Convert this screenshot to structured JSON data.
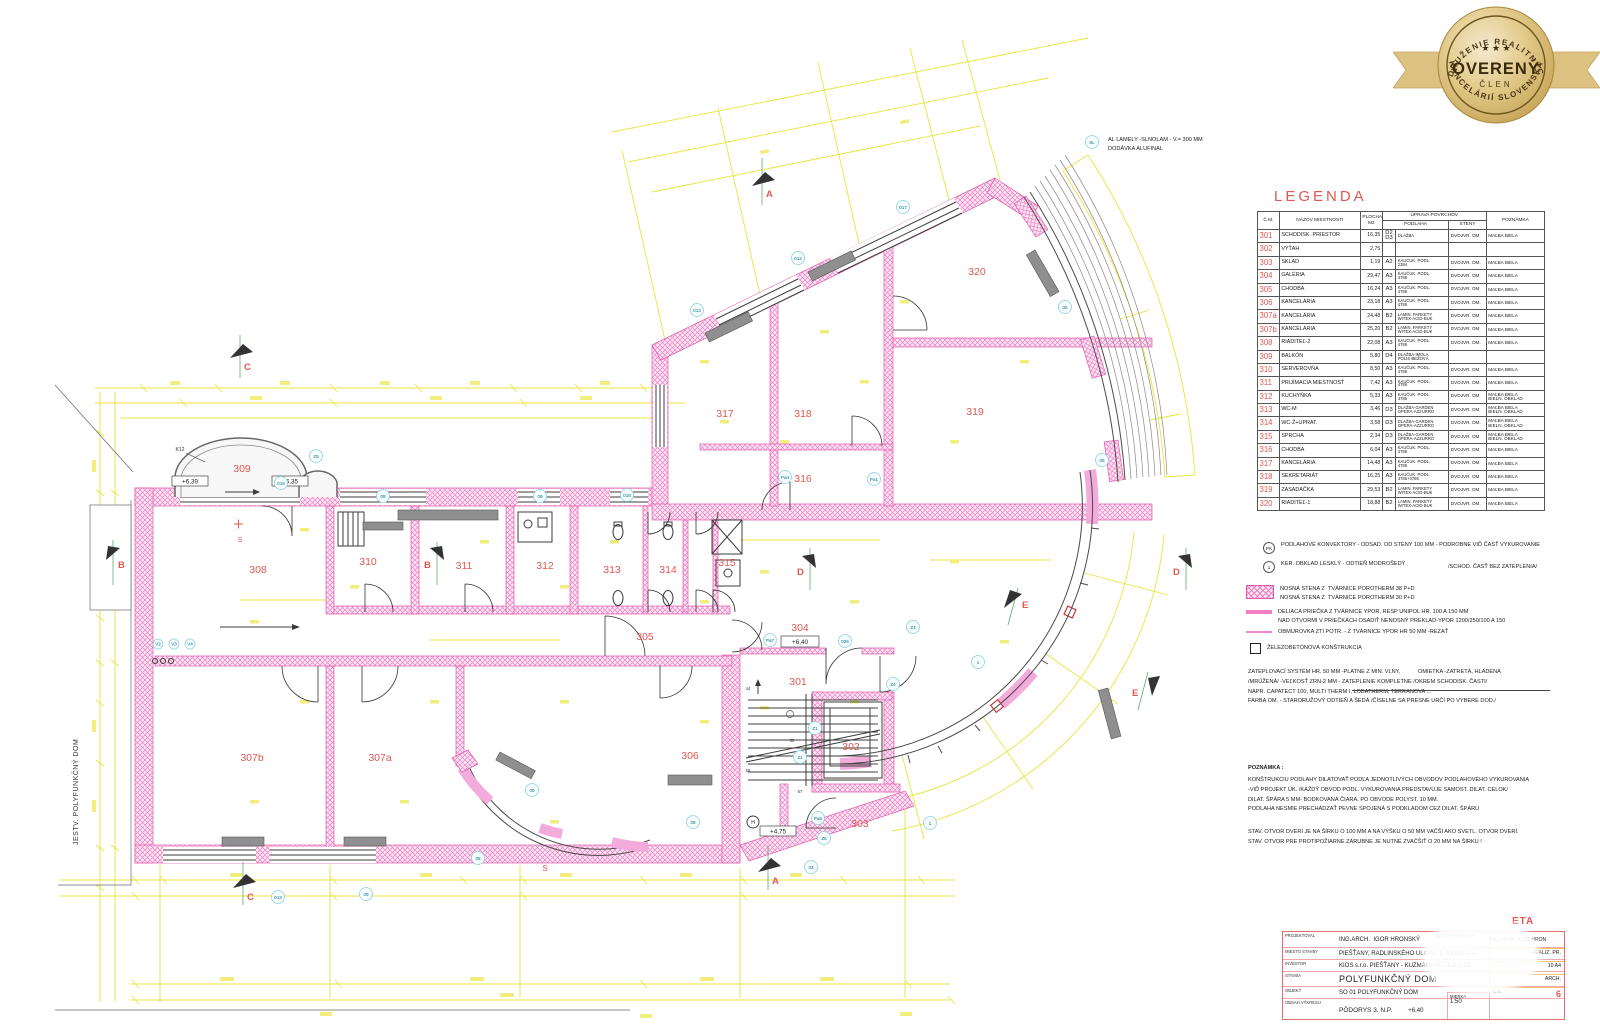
{
  "badge": {
    "arc_top": "ZDRUŽENIE REALITNÝCH",
    "arc_bottom": "KANCELÁRIÍ SLOVENSKA",
    "center": "OVERENÝ",
    "sub": "ČLEN"
  },
  "plan": {
    "existing_label": "JESTV. POLYFUNKČNÝ DOM",
    "sl_code": "SL",
    "sl_line1": "AL LAMELY -SLNOLAM - V.= 300 MM",
    "sl_line2": "DODÁVKA ALUFINAL",
    "k12": "K12",
    "s_label": "S",
    "rooms": [
      "301",
      "302",
      "303",
      "304",
      "305",
      "306",
      "307a",
      "307b",
      "308",
      "309",
      "310",
      "311",
      "312",
      "313",
      "314",
      "315",
      "316",
      "317",
      "318",
      "319",
      "320"
    ],
    "levels": [
      "+6,39",
      "+6,35",
      "+6,40",
      "+4,75"
    ],
    "sections": [
      "A",
      "B",
      "C",
      "D",
      "E"
    ],
    "marks": [
      "019",
      "09",
      "09",
      "018",
      "013",
      "012",
      "017",
      "05",
      "05",
      "Z5",
      "026",
      "Z4",
      "1",
      "1",
      "Pa4",
      "Pa1",
      "Pa7",
      "Pa5",
      "21",
      "Z6",
      "Z4",
      "03",
      "08",
      "013",
      "09",
      "08",
      "09",
      "Z1",
      "V2",
      "V3",
      "V4",
      "H"
    ],
    "stair_marks": [
      "44",
      "50",
      "58",
      "57"
    ]
  },
  "legend": {
    "title": "LEGENDA",
    "headers": {
      "cm": "Č.M.",
      "name": "NÁZOV MIESTNOSTI",
      "area": "PLOCHA\nM2",
      "surfaces": "ÚPRAVA POVRCHOV",
      "floor": "PODLAHA",
      "walls": "STENY",
      "note": "POZNÁMKA"
    },
    "rows": [
      {
        "cm": "301",
        "name": "SCHODISK. PRIESTOR",
        "area": "16,35",
        "code": "D2\nD3",
        "floor": "DLAŽBA",
        "walls": "DVOJVR. OM.",
        "note": "MAĽBA BIELA"
      },
      {
        "cm": "302",
        "name": "VÝŤAH",
        "area": "2,75",
        "code": "",
        "floor": "",
        "walls": "",
        "note": ""
      },
      {
        "cm": "303",
        "name": "SKLAD",
        "area": "1,19",
        "code": "A2",
        "floor": "KAUČUK. PODL.\n2394",
        "walls": "DVOJVR. OM.",
        "note": "MAĽBA BIELA"
      },
      {
        "cm": "304",
        "name": "GALÉRIA",
        "area": "29,47",
        "code": "A3",
        "floor": "KAUČUK. PODL.\n4786",
        "walls": "DVOJVR. OM.",
        "note": "MAĽBA BIELA"
      },
      {
        "cm": "305",
        "name": "CHODBA",
        "area": "16,24",
        "code": "A3",
        "floor": "KAUČUK. PODL.\n4786",
        "walls": "DVOJVR. OM.",
        "note": "MAĽBA BIELA"
      },
      {
        "cm": "306",
        "name": "KANCELÁRIA",
        "area": "23,18",
        "code": "A3",
        "floor": "KAUČUK. PODL.\n4786",
        "walls": "DVOJVR. OM.",
        "note": "MAĽBA BIELA"
      },
      {
        "cm": "307a",
        "name": "KANCELÁRIA",
        "area": "24,48",
        "code": "B2",
        "floor": "LAMIN. PARKETY\nWITEX-ACID-BUK",
        "walls": "DVOJVR. OM.",
        "note": "MAĽBA BIELA"
      },
      {
        "cm": "307b",
        "name": "KANCELÁRIA",
        "area": "25,20",
        "code": "B2",
        "floor": "LAMIN. PARKETY\nWITEX-ACID-BUK",
        "walls": "DVOJVR. OM.",
        "note": "MAĽBA BIELA"
      },
      {
        "cm": "308",
        "name": "RIADITEĽ-2",
        "area": "22,08",
        "code": "A3",
        "floor": "KAUČUK. PODL.\n4786",
        "walls": "DVOJVR. OM.",
        "note": "MAĽBA BIELA"
      },
      {
        "cm": "309",
        "name": "BALKÓN",
        "area": "5,80",
        "code": "D4",
        "floor": "DLAŽBA-IMOLA\nPOLIS-BEŽOVÁ",
        "walls": "",
        "note": ""
      },
      {
        "cm": "310",
        "name": "SERVEROVŇA",
        "area": "8,50",
        "code": "A3",
        "floor": "KAUČUK. PODL.\n4786",
        "walls": "DVOJVR. OM.",
        "note": "MAĽBA BIELA"
      },
      {
        "cm": "311",
        "name": "PRIJÍMACIA MIESTNOSŤ",
        "area": "7,42",
        "code": "A3",
        "floor": "KAUČUK. PODL.\n4786",
        "walls": "DVOJVR. OM.",
        "note": "MAĽBA BIELA"
      },
      {
        "cm": "312",
        "name": "KUCHYŇKA",
        "area": "5,33",
        "code": "A3",
        "floor": "KAUČUK. PODL.\n4785",
        "walls": "DVOJVR. OM.",
        "note": "MAĽBA BIELA\nBIELN. OBKLAD"
      },
      {
        "cm": "313",
        "name": "WC-M",
        "area": "3,46",
        "code": "D3",
        "floor": "DLAŽBA-GARDEN\nOPERA-AZZURRO",
        "walls": "DVOJVR. OM.",
        "note": "MAĽBA BIELA\nBIELN. OBKLAD"
      },
      {
        "cm": "314",
        "name": "WC-Ž+UPRAT.",
        "area": "3,58",
        "code": "D3",
        "floor": "DLAŽBA-GARDEN\nOPERA-AZZURRO",
        "walls": "DVOJVR. OM.",
        "note": "MAĽBA BIELA\nBIELN. OBKLAD"
      },
      {
        "cm": "315",
        "name": "SPRCHA",
        "area": "2,34",
        "code": "D3",
        "floor": "DLAŽBA-GARDEN\nOPERA-AZZURRO",
        "walls": "DVOJVR. OM.",
        "note": "MAĽBA BIELA\nBIELN. OBKLAD"
      },
      {
        "cm": "316",
        "name": "CHODBA",
        "area": "6,04",
        "code": "A3",
        "floor": "KAUČUK. PODL.\n4786",
        "walls": "DVOJVR. OM.",
        "note": "MAĽBA BIELA"
      },
      {
        "cm": "317",
        "name": "KANCELÁRIA",
        "area": "14,48",
        "code": "A3",
        "floor": "KAUČUK. PODL.\n4786",
        "walls": "DVOJVR. OM.",
        "note": "MAĽBA BIELA"
      },
      {
        "cm": "318",
        "name": "SEKRETARIÁT",
        "area": "16,25",
        "code": "A3",
        "floor": "KAUČUK. PODL.\n4786+4785",
        "walls": "DVOJVR. OM.",
        "note": "MAĽBA BIELA"
      },
      {
        "cm": "319",
        "name": "ZASADAČKA",
        "area": "29,53",
        "code": "B2",
        "floor": "LAMIN. PARKETY\nWITEX-ACID-BUK",
        "walls": "DVOJVR. OM.",
        "note": "MAĽBA BIELA"
      },
      {
        "cm": "320",
        "name": "RIADITEĽ-1",
        "area": "18,88",
        "code": "B2",
        "floor": "LAMIN. PARKETY\nWITEX-ACID-BUK",
        "walls": "DVOJVR. OM.",
        "note": "MAĽBA BIELA"
      }
    ]
  },
  "notes": {
    "pk_sym": "PK",
    "pk_text": "PODLAHOVÉ KONVEKTORY - ODSAD. OD STENY 100 MM - PODROBNE VIĎ ČASŤ VYKUROVANIE",
    "one_sym": "1",
    "one_text": "KER. OBKLAD LESKLÝ - ODTIEŇ MODROŠEDÝ",
    "one_note": "/SCHOD. ČASŤ BEZ ZATEPLENIA/",
    "wall_l1a": "NOSNÁ STENA Z",
    "wall_l1b": "TVÁRNICE POROTHERM 38 P+D",
    "wall_l2a": "NOSNÁ STENA Z",
    "wall_l2b": "TVÁRNICE POROTHERM 30 P+D",
    "part_l1": "DELIACA PRIEČKA Z TVÁRNICE YPOR, RESP UNIPOL HR. 100 A 150 MM",
    "part_l2": "NAD OTVORMI V PRIEČKACH OSADIŤ NENOSNÝ PREKLAD-YPOR 1200/250/100 A 150",
    "obmur": "OBMUROVKA ZTI POTR. - Z TVÁRNICE YPOR HR 50 MM -REZAŤ",
    "zelezo": "ŽELEZOBETÓNOVÁ KONŠTRUKCIA",
    "zat_l1": "ZATEPLOVACÍ SYSTÉM HR. 50 MM -PLATNE Z MIN. VLNY,",
    "zat_r1": "OMIETKA -ZATRETÁ, HLADENÁ",
    "zat_l2": "/MRÚŽENÁ/ -VEĽKOSŤ ZRN-2 MM - ZATEPLENIE KOMPLETNE /OKREM SCHODISK. ČASTI/",
    "zat_l3": "NAPR. CAPATECT 100, MULTI THERM I, LOBATHERM, TERRANOVA ...",
    "zat_l4": "FARBA OM. - STARORUŽOVÝ ODTIEŇ A ŠEDÁ /ČÍSELNE SA PRESNE URČÍ PO VÝBERE DOD./",
    "pozn_title": "POZNÁMKA :",
    "pozn_l1": "KONŠTRUKCIU PODLAHY DILATOVAŤ PODĽA JEDNOTLIVÝCH OBVODOV PODLAHOVÉHO VYKUROVANIA",
    "pozn_l2": "-VIĎ PROJEKT ÚK. /KAŽDÝ OBVOD PODL. VYKUROVANIA PREDSTAVUJE SAMOST. DILAT. CELOK/",
    "pozn_l3": "DILAT. ŠPÁRA 5 MM- BODKOVANÁ ČIARA, PO OBVODE POLYST. 10 MM.",
    "pozn_l4": "PODLAHA NESMIE PRECHÁDZAŤ PEVNE SPOJENÁ S PODKLADOM CEZ DILAT. ŠPÁRU",
    "stav_l1": "STAV. OTVOR DVERÍ JE NA ŠÍRKU O 100 MM A NA VÝŠKU O 50 MM VAČŠÍ AKO SVETL. OTVOR DVERÍ.",
    "stav_l2": "STAV. OTVOR PRE PROTIPOŽIARNE ZÁRUBNE JE NUTNÉ ZVAČŠIŤ O 20 MM NA ŠÍRKU !"
  },
  "titleblock": {
    "projektoval_label": "PROJEKTOVAL",
    "projektoval_role": "ING.ARCH.",
    "projektoval_name": "IGOR HRONSKÝ",
    "zodp_label": "ZODP.PROJEKTANT",
    "zodp_role": "ING.ARCH.",
    "zodp_name": "IGOR HRON",
    "miesto_label": "MIESTO STAVBY",
    "miesto": "PIEŠŤANY, RADLINSKÉHO ULICA č.p. 6308/2-3-4",
    "investor_label": "INVESTOR",
    "investor": "KIOS s.r.o. PIEŠŤANY - KUZMÁNYHO ULICA 13",
    "stavba_label": "STAVBA",
    "stavba": "POLYFUNKČNÝ DOM",
    "objekt_label": "OBJEKT",
    "objekt": "SO 01 POLYFUNKČNÝ DOM",
    "obsah_label": "OBSAH VÝKRESU",
    "obsah": "PÔDORYS 3. N.P.",
    "obsah_level": "+6,40",
    "mierka_label": "MIERKA",
    "mierka": "1:50",
    "etapa": "ETA",
    "realiz": "REALIZ. PR.",
    "format": "10 A4",
    "arch": "ARCH.",
    "cv_label": "Č.V.",
    "cv": "6"
  }
}
